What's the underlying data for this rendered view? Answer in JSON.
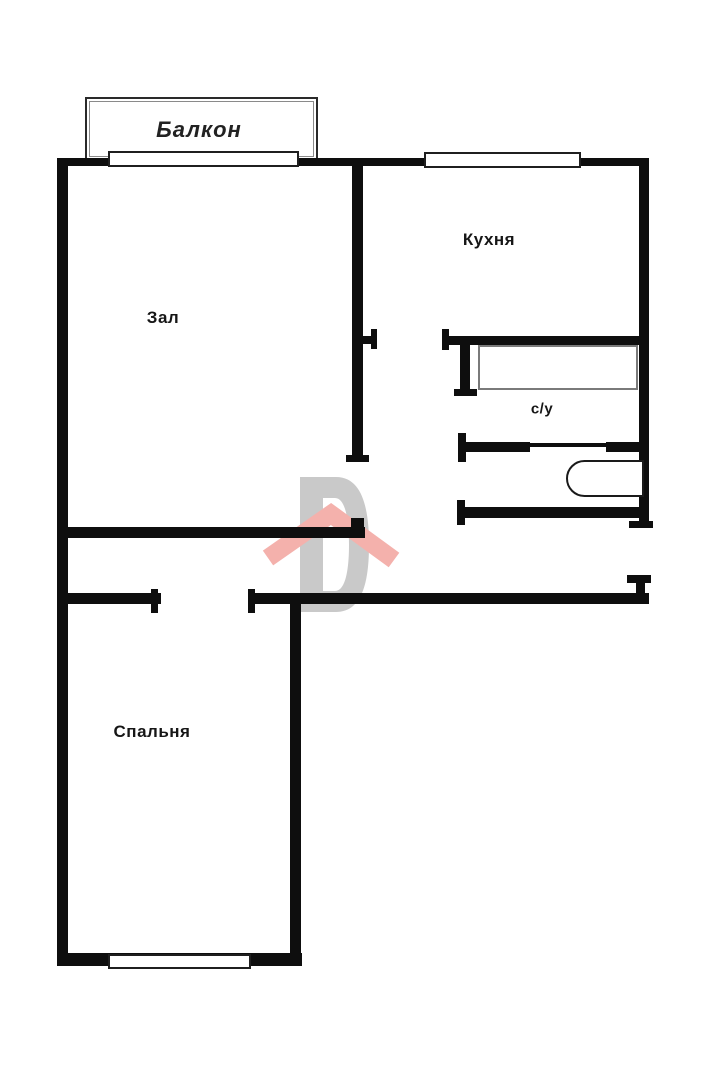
{
  "floorplan": {
    "type": "apartment-floor-plan",
    "rooms": {
      "balcony": {
        "label": "Балкон"
      },
      "living": {
        "label": "Зал"
      },
      "kitchen": {
        "label": "Кухня"
      },
      "bathroom": {
        "label": "с/у"
      },
      "bedroom": {
        "label": "Спальня"
      }
    },
    "fixtures": {
      "bathtub": "bathtub",
      "toilet": "toilet",
      "windows": [
        "balcony-window",
        "kitchen-window",
        "bedroom-window"
      ]
    },
    "watermark": {
      "description": "gray letter D with pink house roof",
      "letter": "D"
    },
    "colors": {
      "wall": "#0e0e0e",
      "background": "#ffffff",
      "watermark_gray": "#c9c9c9",
      "watermark_pink": "#f4b1ac",
      "fixture_gray": "#7a7a7a"
    }
  }
}
